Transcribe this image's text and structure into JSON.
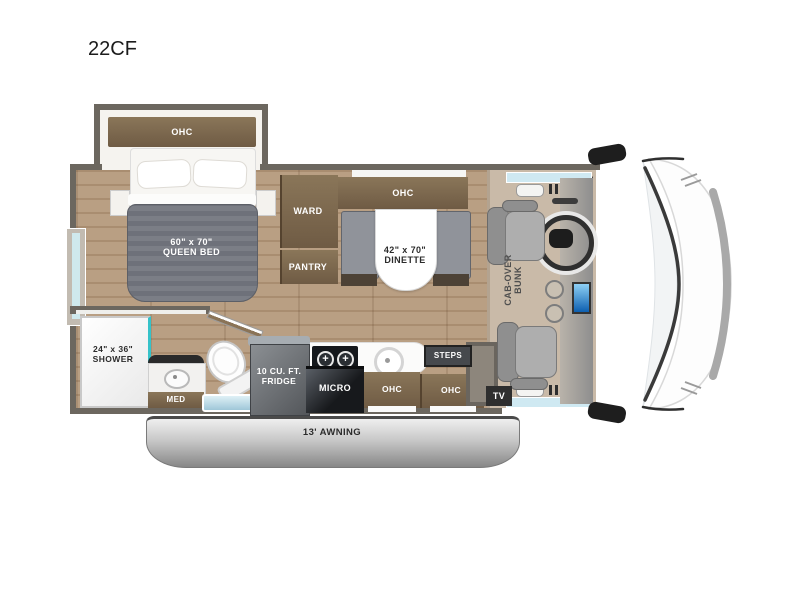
{
  "title": "22CF",
  "bedroom": {
    "ohc": "OHC",
    "bed": {
      "dim": "60\" x 70\"",
      "name": "QUEEN BED"
    },
    "ward": "WARD",
    "pantry": "PANTRY"
  },
  "dinette": {
    "ohc": "OHC",
    "dim": "42\" x 70\"",
    "name": "DINETTE"
  },
  "bathroom": {
    "shower_dim": "24\" x 36\"",
    "shower_name": "SHOWER",
    "med": "MED"
  },
  "kitchen": {
    "fridge": [
      "10 CU. FT.",
      "FRIDGE"
    ],
    "micro": "MICRO",
    "ohc_left": "OHC",
    "ohc_right": "OHC",
    "steps": "STEPS"
  },
  "cab": {
    "bunk": [
      "CAB-OVER",
      "BUNK"
    ],
    "tv": "TV"
  },
  "exterior": {
    "awning": "13' AWNING"
  },
  "colors": {
    "wall": "#6C675F",
    "wood_floor": "#B79D81",
    "cabinet_brown": "#7D6A52",
    "bed_gray": "#75787F",
    "teal_accent": "#35C2C9",
    "window_blue": "#CFE9F2",
    "awning_gray": "#9C9C9C",
    "screen_blue": "#1E78C8"
  }
}
